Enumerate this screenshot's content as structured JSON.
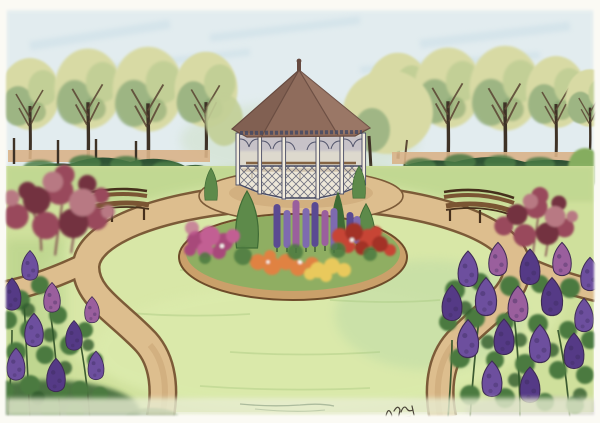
{
  "artwork": {
    "medium": "watercolor and ink garden illustration",
    "subject": "formal garden: octagonal white gazebo with brown roof, circular sandy path, central oval flower bed with conifers and delphinium spikes, two curved wooden benches, tree rows behind a dark hedge, maroon shrubs and purple lilac bushes in the foreground corners",
    "signature_note": "small illegible cursive initials near lower right of lawn"
  },
  "scene": {
    "trees_back_row_left": 4,
    "trees_back_row_right": 5,
    "gazebo_posts_visible": 6,
    "benches": 2,
    "maroon_bushes": 2,
    "lilac_bushes": 2,
    "lilac_cones_left": 9,
    "lilac_cones_right": 16,
    "delphinium_spikes_in_bed": 9
  },
  "palette": {
    "paper": "#fbfaf4",
    "sky": "#e2ecef",
    "sky_streak": "#c8dde6",
    "distant_green": "#cfe0c8",
    "tree_foliage_light": "#d8daa4",
    "tree_foliage_mid": "#c2cf96",
    "tree_foliage_sage": "#93ae7e",
    "tree_foliage_dark": "#6f9460",
    "trunk": "#5d4936",
    "trunk_dark": "#3e3226",
    "fence_band": "#d9b288",
    "hedge_dark": "#2e5233",
    "hedge_mid": "#4a7a45",
    "hedge_light": "#85ad5f",
    "lawn_base": "#cfe09c",
    "lawn_light": "#ddecae",
    "lawn_shadow": "#a4c67c",
    "lawn_cool": "#b9d8a6",
    "path_fill": "#ddbe8e",
    "path_shadow": "#c8a272",
    "path_edge": "#7c5b38",
    "roof": "#8f6c5c",
    "roof_dark": "#664a40",
    "roof_light": "#a5826f",
    "gazebo_wood": "#f2ecdc",
    "gazebo_ink": "#474a63",
    "gazebo_interior": "#ddd8cc",
    "gazebo_shadow": "#b9b4c6",
    "bench_wood": "#7a5533",
    "bench_dark": "#46301c",
    "conifer": "#5d8a4a",
    "conifer_dark": "#3f6b35",
    "maroon_bush": "#99495b",
    "maroon_dark": "#73303f",
    "maroon_light": "#b87983",
    "lilac_purple": "#6d4f9e",
    "lilac_violet": "#553a86",
    "lilac_pink": "#9a5f9d",
    "leaf_green": "#4b7a3f",
    "leaf_dark": "#2f5a2e",
    "stem_green": "#3c5a30",
    "delphinium": "#7e6ab0",
    "delphinium_dark": "#5a4a92",
    "pink_flower": "#c25f93",
    "magenta_flower": "#a84a7a",
    "red_flower": "#c74436",
    "red_dark": "#a33328",
    "orange_flower": "#e08243",
    "yellow_flower": "#e9c95b",
    "bed_rim": "#caa06a",
    "bed_rim_edge": "#6e4c2a",
    "bed_green": "#8fae62",
    "bottom_wash": "#e8edd2",
    "pencil_streak": "#7d9478",
    "cone_outline": "#3e2b55",
    "signature_ink": "#4a4438"
  }
}
